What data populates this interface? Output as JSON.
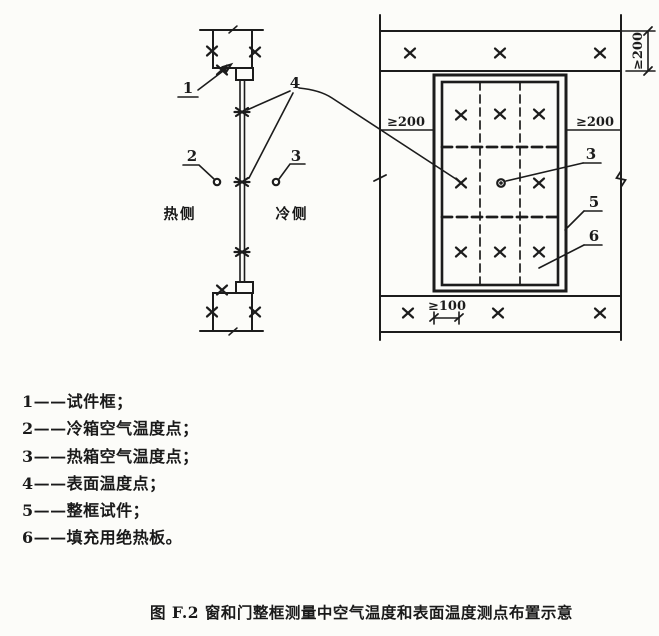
{
  "figure_caption": "图 F.2  窗和门整框测量中空气温度和表面温度测点布置示意",
  "legend": {
    "items": [
      "1——试件框；",
      "2——冷箱空气温度点；",
      "3——热箱空气温度点；",
      "4——表面温度点；",
      "5——整框试件；",
      "6——填充用绝热板。"
    ]
  },
  "section_view": {
    "hot_side_label": "热侧",
    "cold_side_label": "冷侧",
    "callouts": {
      "specimen_frame": "1",
      "cold_air_point": "2",
      "hot_air_point": "3",
      "surface_point": "4"
    }
  },
  "front_view": {
    "callouts": {
      "hot_air_point": "3",
      "frame_specimen": "5",
      "insulation_board": "6"
    },
    "dimensions": {
      "top_vertical": "≥200",
      "left": "≥200",
      "right": "≥200",
      "bottom": "≥100"
    }
  },
  "colors": {
    "ink": "#1c1c1c",
    "paper": "#fcfcf9"
  }
}
